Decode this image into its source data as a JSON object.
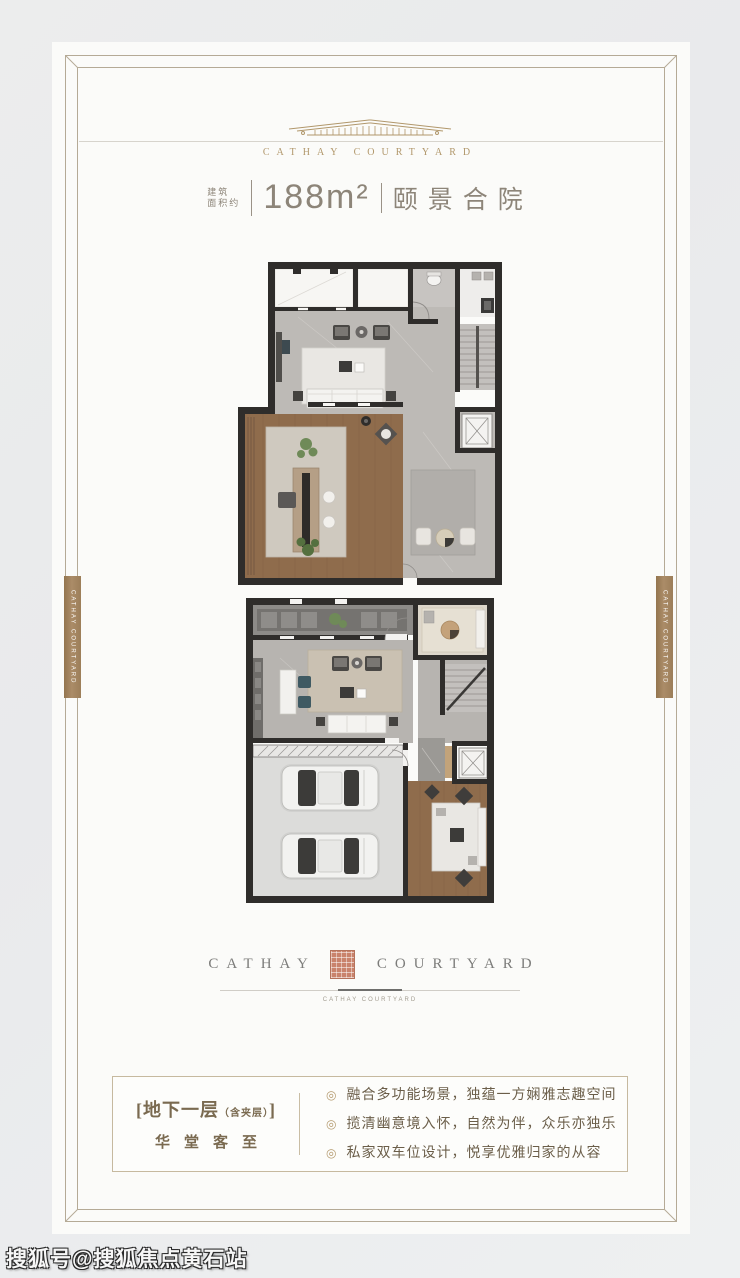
{
  "header": {
    "brand": "CATHAY COURTYARD",
    "area_label_line1": "建筑",
    "area_label_line2": "面积约",
    "area_value": "188m²",
    "unit_name": "颐景合院"
  },
  "side_banners": {
    "left": "CATHAY COURTYARD",
    "right": "CATHAY COURTYARD"
  },
  "logo": {
    "word_left": "CATHAY",
    "word_right": "COURTYARD",
    "subtext": "CATHAY COURTYARD"
  },
  "info_box": {
    "bracket_open": "[",
    "floor_title": "地下一层",
    "floor_note": "（含夹层）",
    "bracket_close": "]",
    "floor_subtitle": "华堂客至",
    "bullet_icon": "◎",
    "bullets": [
      "融合多功能场景，独蕴一方娴雅志趣空间",
      "揽清幽意境入怀，自然为伴，众乐亦独乐",
      "私家双车位设计，悦享优雅归家的从容"
    ]
  },
  "watermark": "搜狐号@搜狐焦点黄石站",
  "colors": {
    "accent_gold": "#b1976b",
    "banner_brown": "#a08261",
    "seal_red": "#c9836c",
    "text_warm_gray": "#8d8579",
    "info_text": "#6b5e49",
    "wall_dark": "#2f2d2b"
  }
}
